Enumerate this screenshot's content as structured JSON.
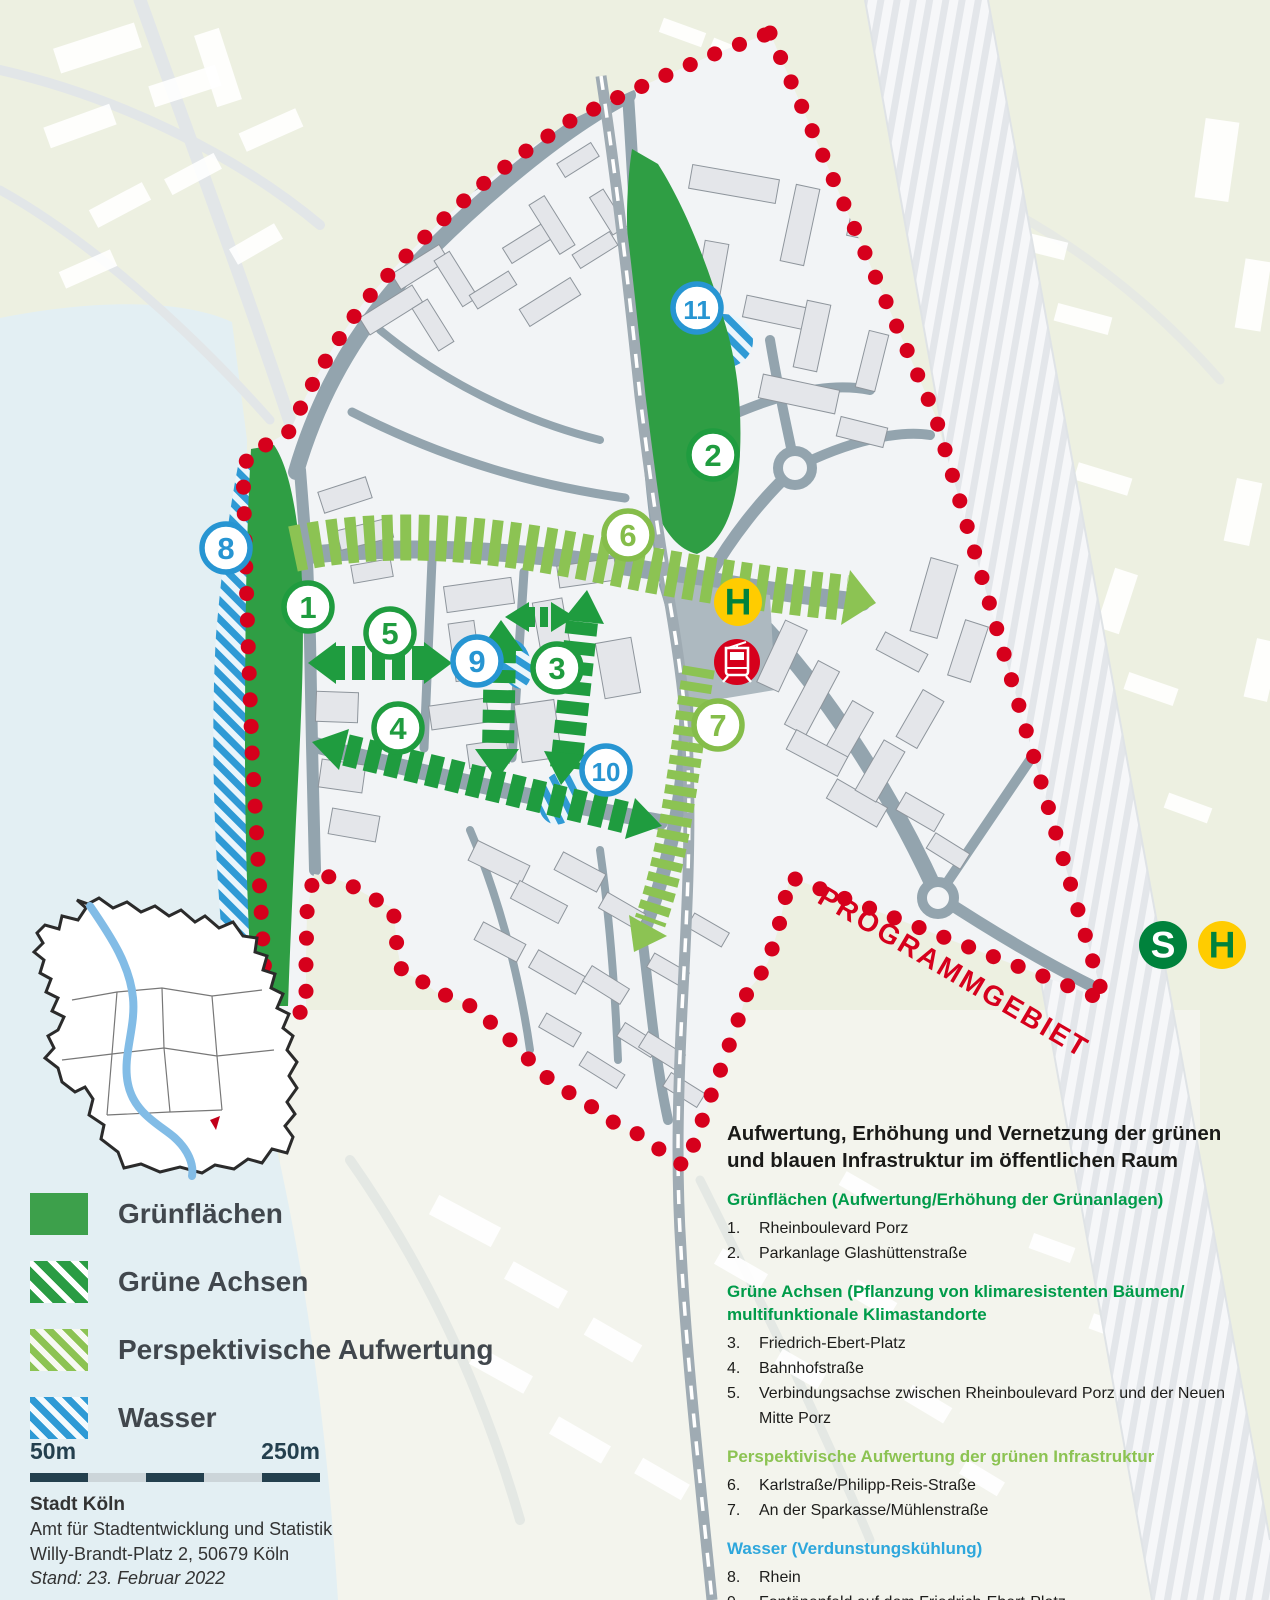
{
  "colors": {
    "green": "#1f9c3f",
    "lightgreen": "#85bd4a",
    "blue": "#2795d2",
    "red": "#d6001c",
    "transit_yellow": "#ffcc00",
    "transit_green": "#00823c"
  },
  "map": {
    "boundary_label": "PROGRAMMGEBIET",
    "markers": [
      {
        "n": "1",
        "tone": "green",
        "x": 308,
        "y": 607
      },
      {
        "n": "2",
        "tone": "green",
        "x": 713,
        "y": 455
      },
      {
        "n": "3",
        "tone": "green",
        "x": 557,
        "y": 668
      },
      {
        "n": "4",
        "tone": "green",
        "x": 398,
        "y": 728
      },
      {
        "n": "5",
        "tone": "green",
        "x": 390,
        "y": 633
      },
      {
        "n": "6",
        "tone": "lightgreen",
        "x": 628,
        "y": 535
      },
      {
        "n": "7",
        "tone": "lightgreen",
        "x": 718,
        "y": 725
      },
      {
        "n": "8",
        "tone": "blue",
        "x": 226,
        "y": 548
      },
      {
        "n": "9",
        "tone": "blue",
        "x": 477,
        "y": 661
      },
      {
        "n": "10",
        "tone": "blue",
        "x": 606,
        "y": 770
      },
      {
        "n": "11",
        "tone": "blue",
        "x": 697,
        "y": 308
      }
    ],
    "transit": [
      {
        "style": "halt",
        "glyph": "H",
        "x": 738,
        "y": 602,
        "r": 24
      },
      {
        "style": "tram",
        "glyph": "",
        "x": 737,
        "y": 662,
        "r": 23
      },
      {
        "style": "sbahn",
        "glyph": "S",
        "x": 1163,
        "y": 945,
        "r": 24
      },
      {
        "style": "halt",
        "glyph": "H",
        "x": 1222,
        "y": 945,
        "r": 24
      }
    ]
  },
  "legend": {
    "items": [
      {
        "label": "Grünflächen",
        "swatch": "solid-green"
      },
      {
        "label": "Grüne Achsen",
        "swatch": "hatch-darkgreen"
      },
      {
        "label": "Perspektivische Aufwertung",
        "swatch": "hatch-lightgreen"
      },
      {
        "label": "Wasser",
        "swatch": "hatch-blue"
      }
    ]
  },
  "scalebar": {
    "left_label": "50m",
    "right_label": "250m"
  },
  "attribution": {
    "org": "Stadt Köln",
    "dept": "Amt für Stadtentwicklung und Statistik",
    "address": "Willy-Brandt-Platz 2, 50679 Köln",
    "date_note": "Stand: 23. Februar 2022"
  },
  "info": {
    "title_line1": "Aufwertung, Erhöhung und Vernetzung der grünen",
    "title_line2": "und blauen Infrastruktur im öffentlichen Raum",
    "sections": [
      {
        "tone": "green",
        "heading_lines": [
          "Grünflächen (Aufwertung/Erhöhung der Grünanlagen)"
        ],
        "items": [
          {
            "num": "1.",
            "text": "Rheinboulevard Porz"
          },
          {
            "num": "2.",
            "text": "Parkanlage Glashüttenstraße"
          }
        ]
      },
      {
        "tone": "green",
        "heading_lines": [
          "Grüne Achsen (Pflanzung von klimaresistenten Bäumen/",
          "multifunktionale Klimastandorte"
        ],
        "items": [
          {
            "num": "3.",
            "text": "Friedrich-Ebert-Platz"
          },
          {
            "num": "4.",
            "text": "Bahnhofstraße"
          },
          {
            "num": "5.",
            "text": "Verbindungsachse zwischen Rheinboulevard Porz und der Neuen Mitte Porz"
          }
        ]
      },
      {
        "tone": "lightgreen",
        "heading_lines": [
          "Perspektivische Aufwertung der grünen Infrastruktur"
        ],
        "items": [
          {
            "num": "6.",
            "text": "Karlstraße/Philipp-Reis-Straße"
          },
          {
            "num": "7.",
            "text": "An der Sparkasse/Mühlenstraße"
          }
        ]
      },
      {
        "tone": "blue",
        "heading_lines": [
          "Wasser (Verdunstungskühlung)"
        ],
        "items": [
          {
            "num": "8.",
            "text": "Rhein"
          },
          {
            "num": "9.",
            "text": "Fontänenfeld auf dem Friedrich-Ebert-Platz"
          },
          {
            "num": "10.",
            "text": "Kugelbrunnen und Trinkbrunnen Bahnhofstraße"
          },
          {
            "num": "11.",
            "text": "Wasserspiel in der Parkanlage Glashüttenstraße"
          }
        ]
      }
    ]
  }
}
